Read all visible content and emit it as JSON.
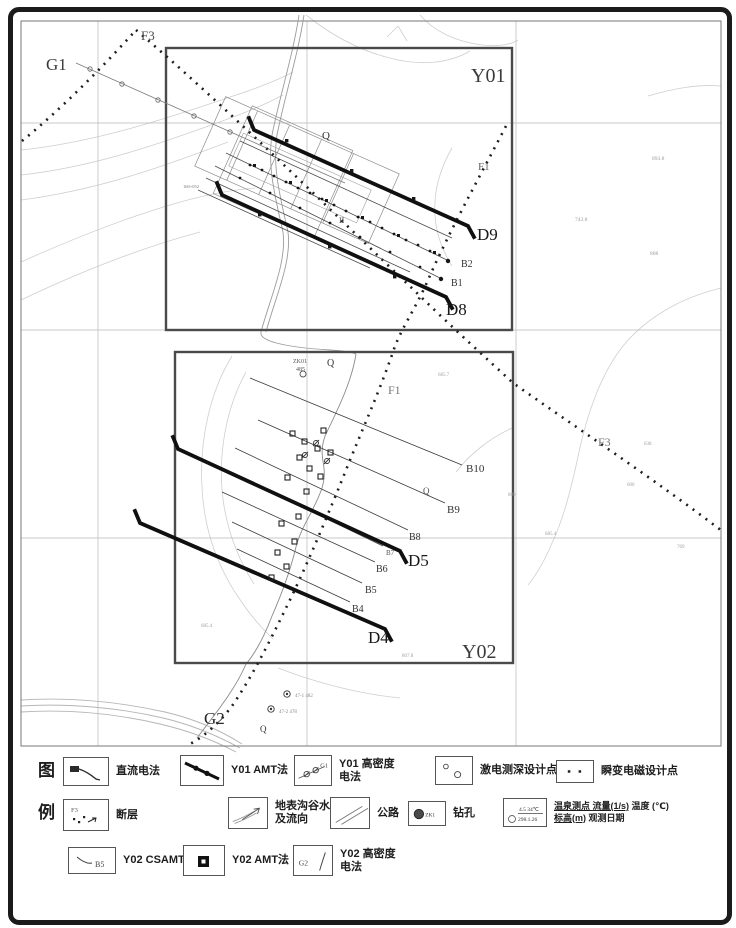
{
  "map": {
    "region_boxes": [
      {
        "name": "Y01"
      },
      {
        "name": "Y02"
      }
    ],
    "labels": [
      {
        "t": "G1",
        "x": 46,
        "y": 70,
        "s": 17,
        "c": "#3a3a3a"
      },
      {
        "t": "F3",
        "x": 141,
        "y": 40,
        "s": 13,
        "c": "#4a4a4a"
      },
      {
        "t": "Y01",
        "x": 471,
        "y": 82,
        "s": 20,
        "c": "#3a3a3a"
      },
      {
        "t": "Q",
        "x": 322,
        "y": 139,
        "s": 11,
        "c": "#333333"
      },
      {
        "t": "F1",
        "x": 478,
        "y": 170,
        "s": 11,
        "c": "#666666"
      },
      {
        "t": "D9",
        "x": 477,
        "y": 240,
        "s": 17,
        "c": "#181818"
      },
      {
        "t": "B2",
        "x": 461,
        "y": 267,
        "s": 10,
        "c": "#333333"
      },
      {
        "t": "B1",
        "x": 451,
        "y": 286,
        "s": 10,
        "c": "#333333"
      },
      {
        "t": "D8",
        "x": 446,
        "y": 315,
        "s": 17,
        "c": "#181818"
      },
      {
        "t": "II",
        "x": 339,
        "y": 223,
        "s": 8,
        "c": "#444444"
      },
      {
        "t": "160+052",
        "x": 183,
        "y": 188,
        "s": 4.5,
        "c": "#777777"
      },
      {
        "t": "893.8",
        "x": 652,
        "y": 160,
        "s": 5.5,
        "c": "#9a9a9a"
      },
      {
        "t": "743.8",
        "x": 575,
        "y": 221,
        "s": 5.5,
        "c": "#9a9a9a"
      },
      {
        "t": "808",
        "x": 650,
        "y": 255,
        "s": 5.5,
        "c": "#9a9a9a"
      },
      {
        "t": "ZK01",
        "x": 293,
        "y": 363,
        "s": 6,
        "c": "#555555"
      },
      {
        "t": "485",
        "x": 296,
        "y": 371,
        "s": 6,
        "c": "#555555"
      },
      {
        "t": "Q",
        "x": 327,
        "y": 366,
        "s": 10,
        "c": "#333333"
      },
      {
        "t": "F1",
        "x": 388,
        "y": 394,
        "s": 12,
        "c": "#777777"
      },
      {
        "t": "685.7",
        "x": 438,
        "y": 376,
        "s": 5,
        "c": "#a0a0a0"
      },
      {
        "t": "B10",
        "x": 466,
        "y": 472,
        "s": 11,
        "c": "#333333"
      },
      {
        "t": "Q",
        "x": 423,
        "y": 494,
        "s": 9,
        "c": "#555555"
      },
      {
        "t": "B9",
        "x": 447,
        "y": 513,
        "s": 11,
        "c": "#333333"
      },
      {
        "t": "B8",
        "x": 409,
        "y": 540,
        "s": 10,
        "c": "#333333"
      },
      {
        "t": "B7",
        "x": 386,
        "y": 555,
        "s": 7,
        "c": "#555555"
      },
      {
        "t": "B6",
        "x": 376,
        "y": 572,
        "s": 10,
        "c": "#333333"
      },
      {
        "t": "B5",
        "x": 365,
        "y": 593,
        "s": 10,
        "c": "#333333"
      },
      {
        "t": "B4",
        "x": 352,
        "y": 612,
        "s": 10,
        "c": "#333333"
      },
      {
        "t": "D5",
        "x": 408,
        "y": 566,
        "s": 17,
        "c": "#181818"
      },
      {
        "t": "D4",
        "x": 368,
        "y": 643,
        "s": 17,
        "c": "#181818"
      },
      {
        "t": "Y02",
        "x": 462,
        "y": 658,
        "s": 20,
        "c": "#3a3a3a"
      },
      {
        "t": "F3",
        "x": 598,
        "y": 446,
        "s": 12,
        "c": "#777777"
      },
      {
        "t": "G2",
        "x": 204,
        "y": 724,
        "s": 17,
        "c": "#2a2a2a"
      },
      {
        "t": "Q",
        "x": 260,
        "y": 732,
        "s": 9,
        "c": "#333333"
      },
      {
        "t": "638",
        "x": 644,
        "y": 445,
        "s": 5,
        "c": "#a0a0a0"
      },
      {
        "t": "600",
        "x": 627,
        "y": 486,
        "s": 5,
        "c": "#a0a0a0"
      },
      {
        "t": "809",
        "x": 508,
        "y": 496,
        "s": 5,
        "c": "#a0a0a0"
      },
      {
        "t": "685.4",
        "x": 545,
        "y": 535,
        "s": 5,
        "c": "#a0a0a0"
      },
      {
        "t": "769",
        "x": 677,
        "y": 548,
        "s": 5,
        "c": "#a0a0a0"
      },
      {
        "t": "685.4",
        "x": 201,
        "y": 627,
        "s": 5,
        "c": "#a0a0a0"
      },
      {
        "t": "807.8",
        "x": 402,
        "y": 657,
        "s": 5,
        "c": "#a0a0a0"
      },
      {
        "t": "47-1 482",
        "x": 295,
        "y": 697,
        "s": 5,
        "c": "#888888"
      },
      {
        "t": "47-2 478",
        "x": 279,
        "y": 713,
        "s": 5,
        "c": "#888888"
      }
    ]
  },
  "legend": {
    "header_top": "图",
    "header_bottom": "例",
    "rows": [
      [
        {
          "symbol": "dc-method",
          "label": "直流电法"
        },
        {
          "symbol": "y01-amt",
          "label": "Y01 AMT法"
        },
        {
          "symbol": "y01-gaomidu",
          "symbol_text": "G1",
          "label": "Y01 高密度\n电法"
        },
        {
          "symbol": "ip-sounding",
          "label": "激电测深设计点"
        },
        {
          "symbol": "tem-point",
          "label": "瞬变电磁设计点"
        }
      ],
      [
        {
          "symbol": "fault",
          "symbol_text": "F3",
          "label": "断层"
        },
        {
          "symbol": "stream",
          "label": "地表沟谷水\n及流向"
        },
        {
          "symbol": "road",
          "label": "公路"
        },
        {
          "symbol": "borehole",
          "symbol_text": "ZK1",
          "label": "钻孔"
        },
        {
          "symbol": "spring",
          "symbol_text_top": "4.5 34℃",
          "symbol_text_bottom": "298.1.26",
          "label_flow": "温泉测点 流量(1/s)",
          "label_temp": "温度 (℃)",
          "label_elev": "标高(m)",
          "label_date": "观测日期"
        }
      ],
      [
        {
          "symbol": "y02-csamt",
          "symbol_text": "B5",
          "label": "Y02 CSAMT法"
        },
        {
          "symbol": "y02-amt",
          "label": "Y02 AMT法"
        },
        {
          "symbol": "y02-gaomidu",
          "symbol_text": "G2",
          "label": "Y02 高密度\n电法"
        }
      ]
    ]
  }
}
